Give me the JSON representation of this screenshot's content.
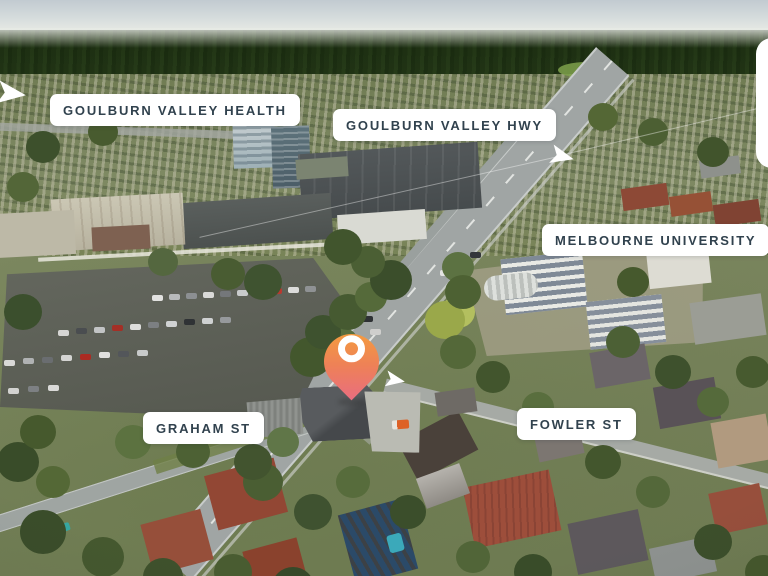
{
  "labels": {
    "health": "GOULBURN VALLEY HEALTH",
    "hwy": "GOULBURN VALLEY HWY",
    "university": "MELBOURNE UNIVERSITY",
    "graham": "GRAHAM ST",
    "fowler": "FOWLER ST"
  },
  "pin": {
    "icon": "location-pin-icon",
    "color_top": "#f6a438",
    "color_bottom": "#e96d80",
    "ring_color": "#ffffff"
  },
  "style": {
    "label_background": "#ffffff",
    "label_text_color": "#31424e",
    "direction_arrow_color": "#ffffff"
  }
}
